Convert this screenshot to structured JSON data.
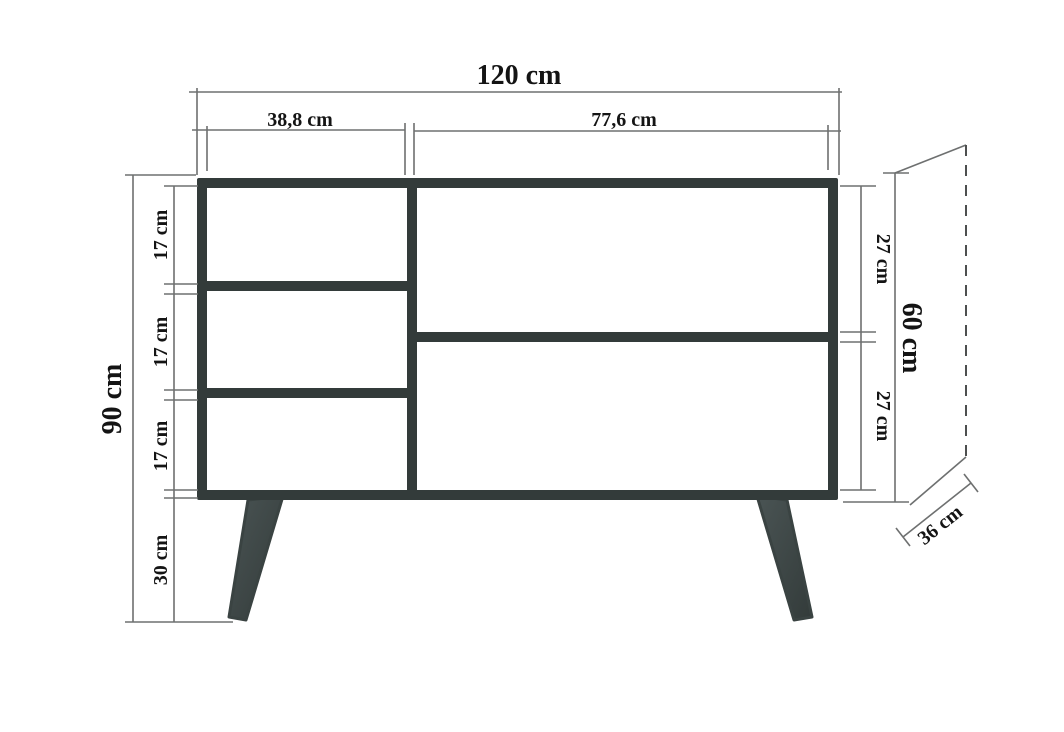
{
  "diagram": {
    "type": "furniture-dimension-drawing",
    "object": "sideboard cabinet with three left compartments, two right compartments and four angled legs",
    "labels": {
      "total_width": "120 cm",
      "left_section_width": "38,8 cm",
      "right_section_width": "77,6 cm",
      "total_height": "90 cm",
      "left_compartment_1": "17 cm",
      "left_compartment_2": "17 cm",
      "left_compartment_3": "17 cm",
      "leg_height": "30 cm",
      "right_compartment_top": "27 cm",
      "right_compartment_bottom": "27 cm",
      "body_height": "60 cm",
      "depth": "36 cm"
    },
    "values_cm": {
      "total_width": 120,
      "left_section_width": 38.8,
      "right_section_width": 77.6,
      "total_height": 90,
      "body_height": 60,
      "left_compartment_height": 17,
      "right_compartment_height": 27,
      "leg_height": 30,
      "depth": 36
    },
    "colors": {
      "frame": "#333b3a",
      "legs": "#3e4747",
      "dimension_lines": "#6e7070",
      "text": "#141414",
      "background": "#ffffff"
    }
  }
}
